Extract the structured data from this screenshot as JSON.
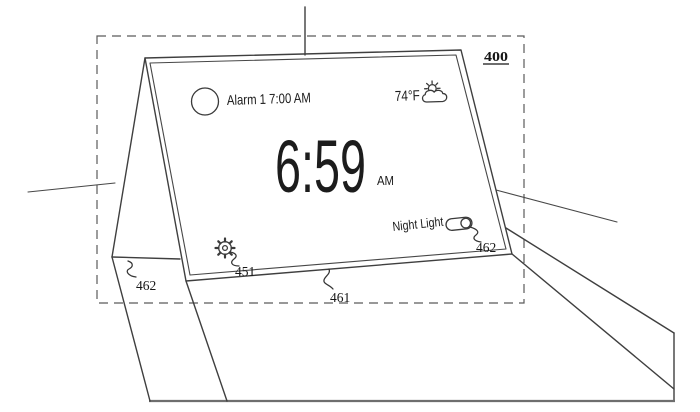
{
  "figure": {
    "number": "400",
    "callout_gear": "451",
    "callout_screen": "461",
    "callout_panel": "462",
    "callout_toggle": "462"
  },
  "screen_ui": {
    "alarm_label": "Alarm 1 7:00 AM",
    "time": "6:59",
    "meridiem": "AM",
    "temperature": "74°F",
    "night_light_label": "Night Light",
    "night_light_state": "on"
  },
  "icons": {
    "alarm_indicator": "circle-outline",
    "weather": "sun-behind-cloud",
    "settings": "gear",
    "night_light": "toggle-switch-on"
  },
  "colors": {
    "line": "#3f3f3f",
    "dash": "#5a5a5a",
    "text": "#1c1c1c",
    "background": "#ffffff"
  }
}
